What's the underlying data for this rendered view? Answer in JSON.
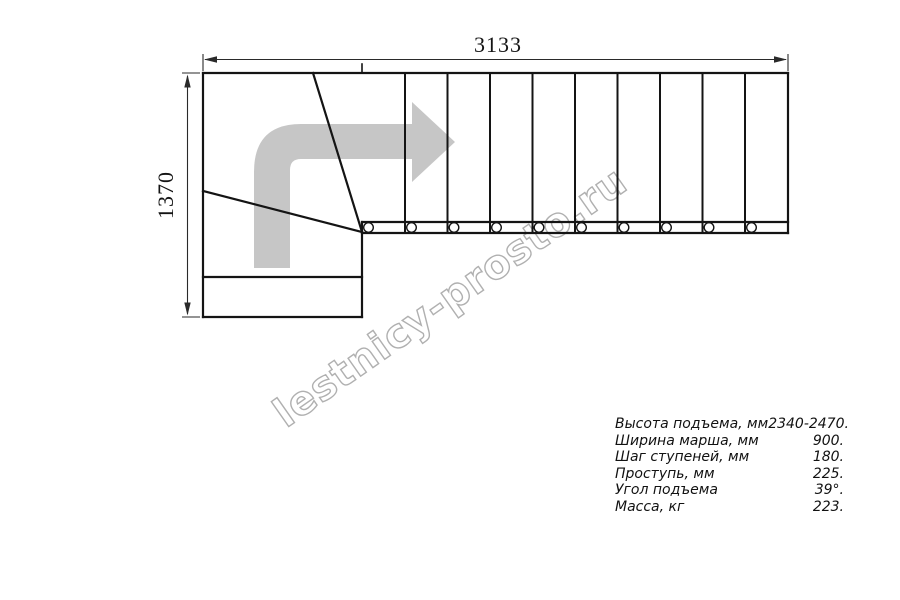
{
  "drawing": {
    "width_dim": "3133",
    "height_dim": "1370",
    "line_color": "#141414",
    "dim_color": "#2a2a2a",
    "arrow_color": "#c6c6c6",
    "straight_step_count": 10,
    "baluster_count": 10
  },
  "watermark": {
    "text": "lestnicy-prosto.ru",
    "color": "#b0b0b0"
  },
  "specs": {
    "rows": [
      {
        "label": "Высота подъема, мм",
        "value": "2340-2470."
      },
      {
        "label": "Ширина марша, мм",
        "value": "900."
      },
      {
        "label": "Шаг ступеней, мм",
        "value": "180."
      },
      {
        "label": "Проступь, мм",
        "value": "225."
      },
      {
        "label": "Угол подъема",
        "value": "39°."
      },
      {
        "label": "Масса, кг",
        "value": "223."
      }
    ]
  }
}
